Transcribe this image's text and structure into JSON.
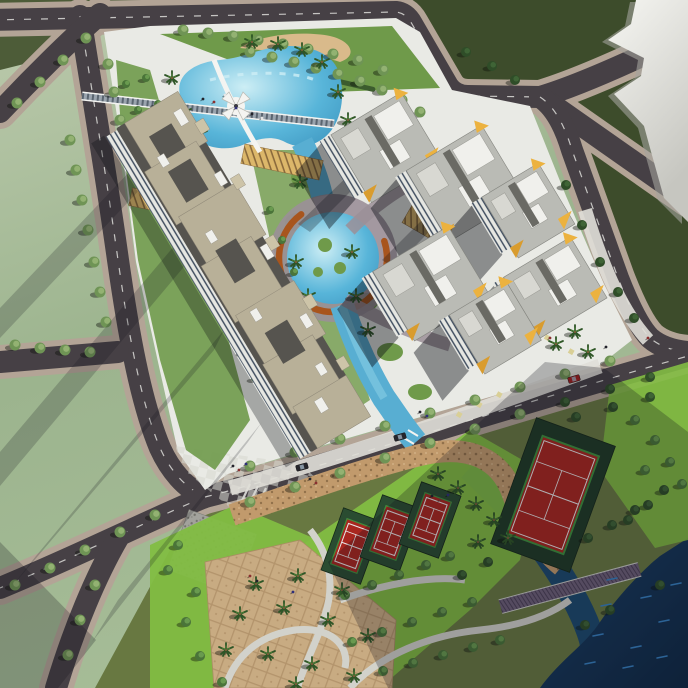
{
  "scene": {
    "title": "aerial-rendering-residential-complex",
    "type": "3d-architectural-site-plan",
    "features": [
      "ring-road-network",
      "kidney-pool-with-x-bridge",
      "long-slab-apartment-building",
      "high-rise-tower-cluster",
      "central-lagoon-with-orange-ring-boardwalk",
      "canal",
      "palm-plaza",
      "tennis-courts",
      "park-with-winding-paths",
      "river-corner"
    ]
  },
  "palette": {
    "road": "#464045",
    "sidewalk": "#b3a496",
    "road_line": "#e6e6e2",
    "block_olive": "#4d5c38",
    "block_olive_dark": "#3d4c2b",
    "streak_edge": "#a3a39c",
    "parcel": "#e9eae5",
    "checker": "#d6d7cf",
    "pave_yellow": "#d9cf96",
    "site_green": "#6f9a4a",
    "site_green_light": "#8ab55e",
    "hedge": "#3c5c2e",
    "sand": "#d9ba8b",
    "pool": "#5cb6d8",
    "canal": "#58aed2",
    "canal_hi": "#8fd4e8",
    "lagoon_ring": "#a8551d",
    "deck_mauve": "#9b8f98",
    "river_hi": "#2c6396",
    "channel": "#1c4a6e",
    "roof_beige": "#b8b098",
    "roof_dark": "#56544f",
    "roof_gray": "#babbb5",
    "roof_white": "#f0f0ec",
    "facade": "#e6e7e2",
    "facade_shade": "#c6c7c1",
    "win": "#3c4a5c",
    "yellow": "#ecb23f",
    "yellow_dark": "#d99c2e",
    "trellis": "#dcb76a",
    "trellis_line": "#8a6a3c",
    "stone": "#a2a29c",
    "pebble": "#c19a6c",
    "pebble_dot": "#92714b",
    "plaza_tan": "#c8ab82",
    "plaza_tan2": "#b3946c",
    "lawn": "#82bd42",
    "court_pad": "#2a4c31",
    "court_pad_dark": "#203b26",
    "court_red": "#a8271f",
    "court_line": "#e8e8e8",
    "court_green": "#3f8f3d",
    "board": "#6e6078",
    "path_light": "#d2d2cb",
    "tree_street": "#6f9455",
    "tree_street_hi": "#93b272",
    "tree_park": "#4a7439",
    "tree_park_hi": "#699a4f",
    "tree_dark": "#2f4d28",
    "tree_dark_hi": "#3f6436",
    "palm": "#2e5526",
    "palm_hi": "#4a7c35",
    "trunk": "#7a5a38",
    "bridge": "#9aa4ae",
    "bridge_truss": "#5a6570",
    "white": "#f4f4f1",
    "car_red": "#a02020",
    "car_dark": "#26262c"
  },
  "roads": [
    {
      "d": "M -10 20 L 396 12 Q 406 13 412 24 L 448 86 Q 455 96 468 96 L 540 97",
      "dash": true
    },
    {
      "d": "M 540 97 Q 590 82 688 34",
      "dash": false
    },
    {
      "d": "M 544 99 L 688 200",
      "dash": false
    },
    {
      "d": "M 540 97 Q 560 110 572 150 L 618 278 Q 636 324 650 338 Q 664 350 688 352",
      "dash": true
    },
    {
      "d": "M 80 16 C 90 80 104 160 118 260 C 128 330 140 400 160 448 C 170 470 185 488 205 497",
      "dash": true
    },
    {
      "d": "M 0 362 L 118 352",
      "dash": false
    },
    {
      "d": "M 205 497 C 160 515 80 555 0 588",
      "dash": true
    },
    {
      "d": "M 118 538 C 96 576 74 628 56 688",
      "dash": false
    },
    {
      "d": "M 100 14 C 70 40 30 80 0 112",
      "dash": false
    },
    {
      "d": "M 205 497 C 320 468 470 418 688 356",
      "dash": true
    }
  ],
  "trees": {
    "street": [
      [
        183,
        30
      ],
      [
        208,
        33
      ],
      [
        233,
        36
      ],
      [
        258,
        40
      ],
      [
        283,
        44
      ],
      [
        308,
        49
      ],
      [
        333,
        54
      ],
      [
        358,
        60
      ],
      [
        383,
        70
      ],
      [
        86,
        38
      ],
      [
        63,
        60
      ],
      [
        40,
        82
      ],
      [
        17,
        103
      ],
      [
        70,
        140
      ],
      [
        76,
        170
      ],
      [
        82,
        200
      ],
      [
        88,
        230
      ],
      [
        94,
        262
      ],
      [
        100,
        292
      ],
      [
        106,
        322
      ],
      [
        15,
        345
      ],
      [
        40,
        348
      ],
      [
        65,
        350
      ],
      [
        90,
        352
      ],
      [
        155,
        515
      ],
      [
        120,
        532
      ],
      [
        85,
        550
      ],
      [
        50,
        568
      ],
      [
        15,
        585
      ],
      [
        95,
        585
      ],
      [
        80,
        620
      ],
      [
        68,
        655
      ],
      [
        250,
        466
      ],
      [
        295,
        452
      ],
      [
        340,
        439
      ],
      [
        385,
        426
      ],
      [
        430,
        413
      ],
      [
        475,
        400
      ],
      [
        520,
        387
      ],
      [
        565,
        374
      ],
      [
        610,
        361
      ],
      [
        250,
        502
      ],
      [
        295,
        487
      ],
      [
        340,
        473
      ],
      [
        385,
        458
      ],
      [
        430,
        443
      ],
      [
        475,
        429
      ],
      [
        520,
        414
      ],
      [
        250,
        52
      ],
      [
        272,
        57
      ],
      [
        294,
        62
      ],
      [
        316,
        68
      ],
      [
        338,
        74
      ],
      [
        360,
        81
      ],
      [
        382,
        90
      ],
      [
        402,
        100
      ],
      [
        420,
        112
      ],
      [
        108,
        64
      ],
      [
        114,
        92
      ],
      [
        120,
        120
      ]
    ],
    "park": [
      [
        345,
        595
      ],
      [
        372,
        585
      ],
      [
        399,
        575
      ],
      [
        426,
        565
      ],
      [
        450,
        556
      ],
      [
        352,
        642
      ],
      [
        382,
        632
      ],
      [
        412,
        622
      ],
      [
        442,
        612
      ],
      [
        472,
        602
      ],
      [
        383,
        671
      ],
      [
        413,
        663
      ],
      [
        443,
        655
      ],
      [
        473,
        647
      ],
      [
        500,
        640
      ],
      [
        196,
        592
      ],
      [
        186,
        622
      ],
      [
        200,
        656
      ],
      [
        222,
        682
      ],
      [
        168,
        570
      ],
      [
        635,
        420
      ],
      [
        655,
        440
      ],
      [
        670,
        462
      ],
      [
        682,
        484
      ],
      [
        645,
        470
      ],
      [
        178,
        545
      ]
    ],
    "dark": [
      [
        600,
        262
      ],
      [
        618,
        292
      ],
      [
        634,
        318
      ],
      [
        582,
        225
      ],
      [
        566,
        185
      ],
      [
        462,
        575
      ],
      [
        488,
        562
      ],
      [
        588,
        538
      ],
      [
        612,
        525
      ],
      [
        635,
        510
      ],
      [
        585,
        625
      ],
      [
        610,
        610
      ],
      [
        660,
        585
      ],
      [
        628,
        520
      ],
      [
        648,
        505
      ],
      [
        664,
        490
      ],
      [
        466,
        52
      ],
      [
        492,
        66
      ],
      [
        515,
        80
      ],
      [
        565,
        402
      ],
      [
        610,
        389
      ],
      [
        650,
        377
      ],
      [
        576,
        417
      ],
      [
        613,
        407
      ],
      [
        650,
        397
      ]
    ],
    "orchard": [
      [
        126,
        84
      ],
      [
        138,
        110
      ],
      [
        149,
        136
      ],
      [
        160,
        162
      ],
      [
        171,
        188
      ],
      [
        146,
        78
      ],
      [
        158,
        104
      ],
      [
        169,
        130
      ],
      [
        180,
        156
      ],
      [
        191,
        182
      ],
      [
        177,
        200
      ],
      [
        188,
        226
      ],
      [
        199,
        252
      ],
      [
        210,
        278
      ],
      [
        197,
        194
      ],
      [
        208,
        220
      ],
      [
        219,
        246
      ],
      [
        230,
        272
      ],
      [
        222,
        300
      ],
      [
        233,
        326
      ],
      [
        244,
        352
      ],
      [
        255,
        378
      ],
      [
        242,
        296
      ],
      [
        253,
        322
      ],
      [
        264,
        348
      ],
      [
        275,
        374
      ],
      [
        270,
        210
      ],
      [
        282,
        240
      ],
      [
        294,
        272
      ]
    ]
  },
  "palms": [
    [
      172,
      78
    ],
    [
      184,
      112
    ],
    [
      200,
      134
    ],
    [
      252,
      42
    ],
    [
      278,
      44
    ],
    [
      302,
      50
    ],
    [
      322,
      62
    ],
    [
      338,
      92
    ],
    [
      348,
      120
    ],
    [
      336,
      142
    ],
    [
      300,
      182
    ],
    [
      296,
      262
    ],
    [
      308,
      296
    ],
    [
      356,
      296
    ],
    [
      368,
      330
    ],
    [
      352,
      252
    ],
    [
      560,
      308
    ],
    [
      575,
      332
    ],
    [
      556,
      344
    ],
    [
      588,
      352
    ],
    [
      438,
      474
    ],
    [
      458,
      488
    ],
    [
      476,
      504
    ],
    [
      494,
      520
    ],
    [
      478,
      542
    ],
    [
      508,
      538
    ],
    [
      256,
      584
    ],
    [
      298,
      576
    ],
    [
      342,
      590
    ],
    [
      240,
      614
    ],
    [
      284,
      608
    ],
    [
      328,
      620
    ],
    [
      368,
      636
    ],
    [
      226,
      650
    ],
    [
      268,
      654
    ],
    [
      312,
      664
    ],
    [
      354,
      676
    ],
    [
      296,
      684
    ]
  ],
  "towers": [
    [
      383,
      142,
      62,
      78
    ],
    [
      462,
      178,
      66,
      84
    ],
    [
      525,
      205,
      54,
      62
    ],
    [
      552,
      282,
      54,
      74
    ],
    [
      428,
      278,
      64,
      84
    ],
    [
      492,
      322,
      52,
      62
    ]
  ],
  "courts": [
    {
      "cx": 352,
      "cy": 546,
      "rot": 20,
      "w": 28,
      "h": 48
    },
    {
      "cx": 391,
      "cy": 533,
      "rot": 20,
      "w": 28,
      "h": 48
    },
    {
      "cx": 430,
      "cy": 520,
      "rot": 20,
      "w": 28,
      "h": 48
    },
    {
      "cx": 553,
      "cy": 495,
      "rot": 20,
      "w": 60,
      "h": 104,
      "big": true
    }
  ],
  "cars": [
    {
      "x": 574,
      "y": 379,
      "a": -16,
      "c": "car_red"
    },
    {
      "x": 400,
      "y": 437,
      "a": -16,
      "c": "car_dark"
    },
    {
      "x": 302,
      "y": 467,
      "a": -15,
      "c": "car_dark"
    }
  ],
  "people": [
    [
      233,
      466,
      0
    ],
    [
      239,
      470,
      1
    ],
    [
      246,
      464,
      2
    ],
    [
      310,
      479,
      0
    ],
    [
      316,
      483,
      1
    ],
    [
      420,
      412,
      0
    ],
    [
      427,
      416,
      2
    ],
    [
      543,
      334,
      0
    ],
    [
      550,
      338,
      1
    ],
    [
      203,
      99,
      0
    ],
    [
      214,
      102,
      1
    ],
    [
      236,
      108,
      2
    ],
    [
      252,
      114,
      0
    ],
    [
      250,
      576,
      1
    ],
    [
      257,
      581,
      0
    ],
    [
      293,
      592,
      2
    ],
    [
      432,
      496,
      0
    ],
    [
      440,
      500,
      1
    ],
    [
      448,
      495,
      2
    ],
    [
      606,
      347,
      0
    ],
    [
      648,
      338,
      1
    ],
    [
      225,
      95,
      3
    ],
    [
      262,
      118,
      3
    ]
  ],
  "people_colors": [
    "#22222a",
    "#8a3030",
    "#2f2f7a",
    "#e6e6e6"
  ],
  "waves": [
    [
      612,
      580
    ],
    [
      646,
      598
    ],
    [
      598,
      636
    ],
    [
      636,
      648
    ],
    [
      664,
      622
    ],
    [
      590,
      664
    ],
    [
      628,
      668
    ],
    [
      662,
      658
    ],
    [
      606,
      606
    ],
    [
      676,
      585
    ]
  ],
  "shadow_bands": [
    {
      "pts": "152,148 0,308 0,338 162,166",
      "o": 0.2
    },
    {
      "pts": "186,232 0,452 0,486 198,250",
      "o": 0.2
    },
    {
      "pts": "224,330 36,556 14,584 214,350",
      "o": 0.2
    },
    {
      "pts": "262,422 118,600 92,642 248,442",
      "o": 0.2
    },
    {
      "pts": "0,542 96,640 58,688 0,688",
      "o": 0.24
    },
    {
      "pts": "328,562 545,362 604,368 688,432 688,688 388,688",
      "o": 0.26
    },
    {
      "pts": "356,168 298,224 310,232 366,176",
      "o": 0.28
    },
    {
      "pts": "440,202 382,260 394,268 450,210",
      "o": 0.28
    },
    {
      "pts": "512,298 458,350 468,358 520,306",
      "o": 0.28
    }
  ]
}
